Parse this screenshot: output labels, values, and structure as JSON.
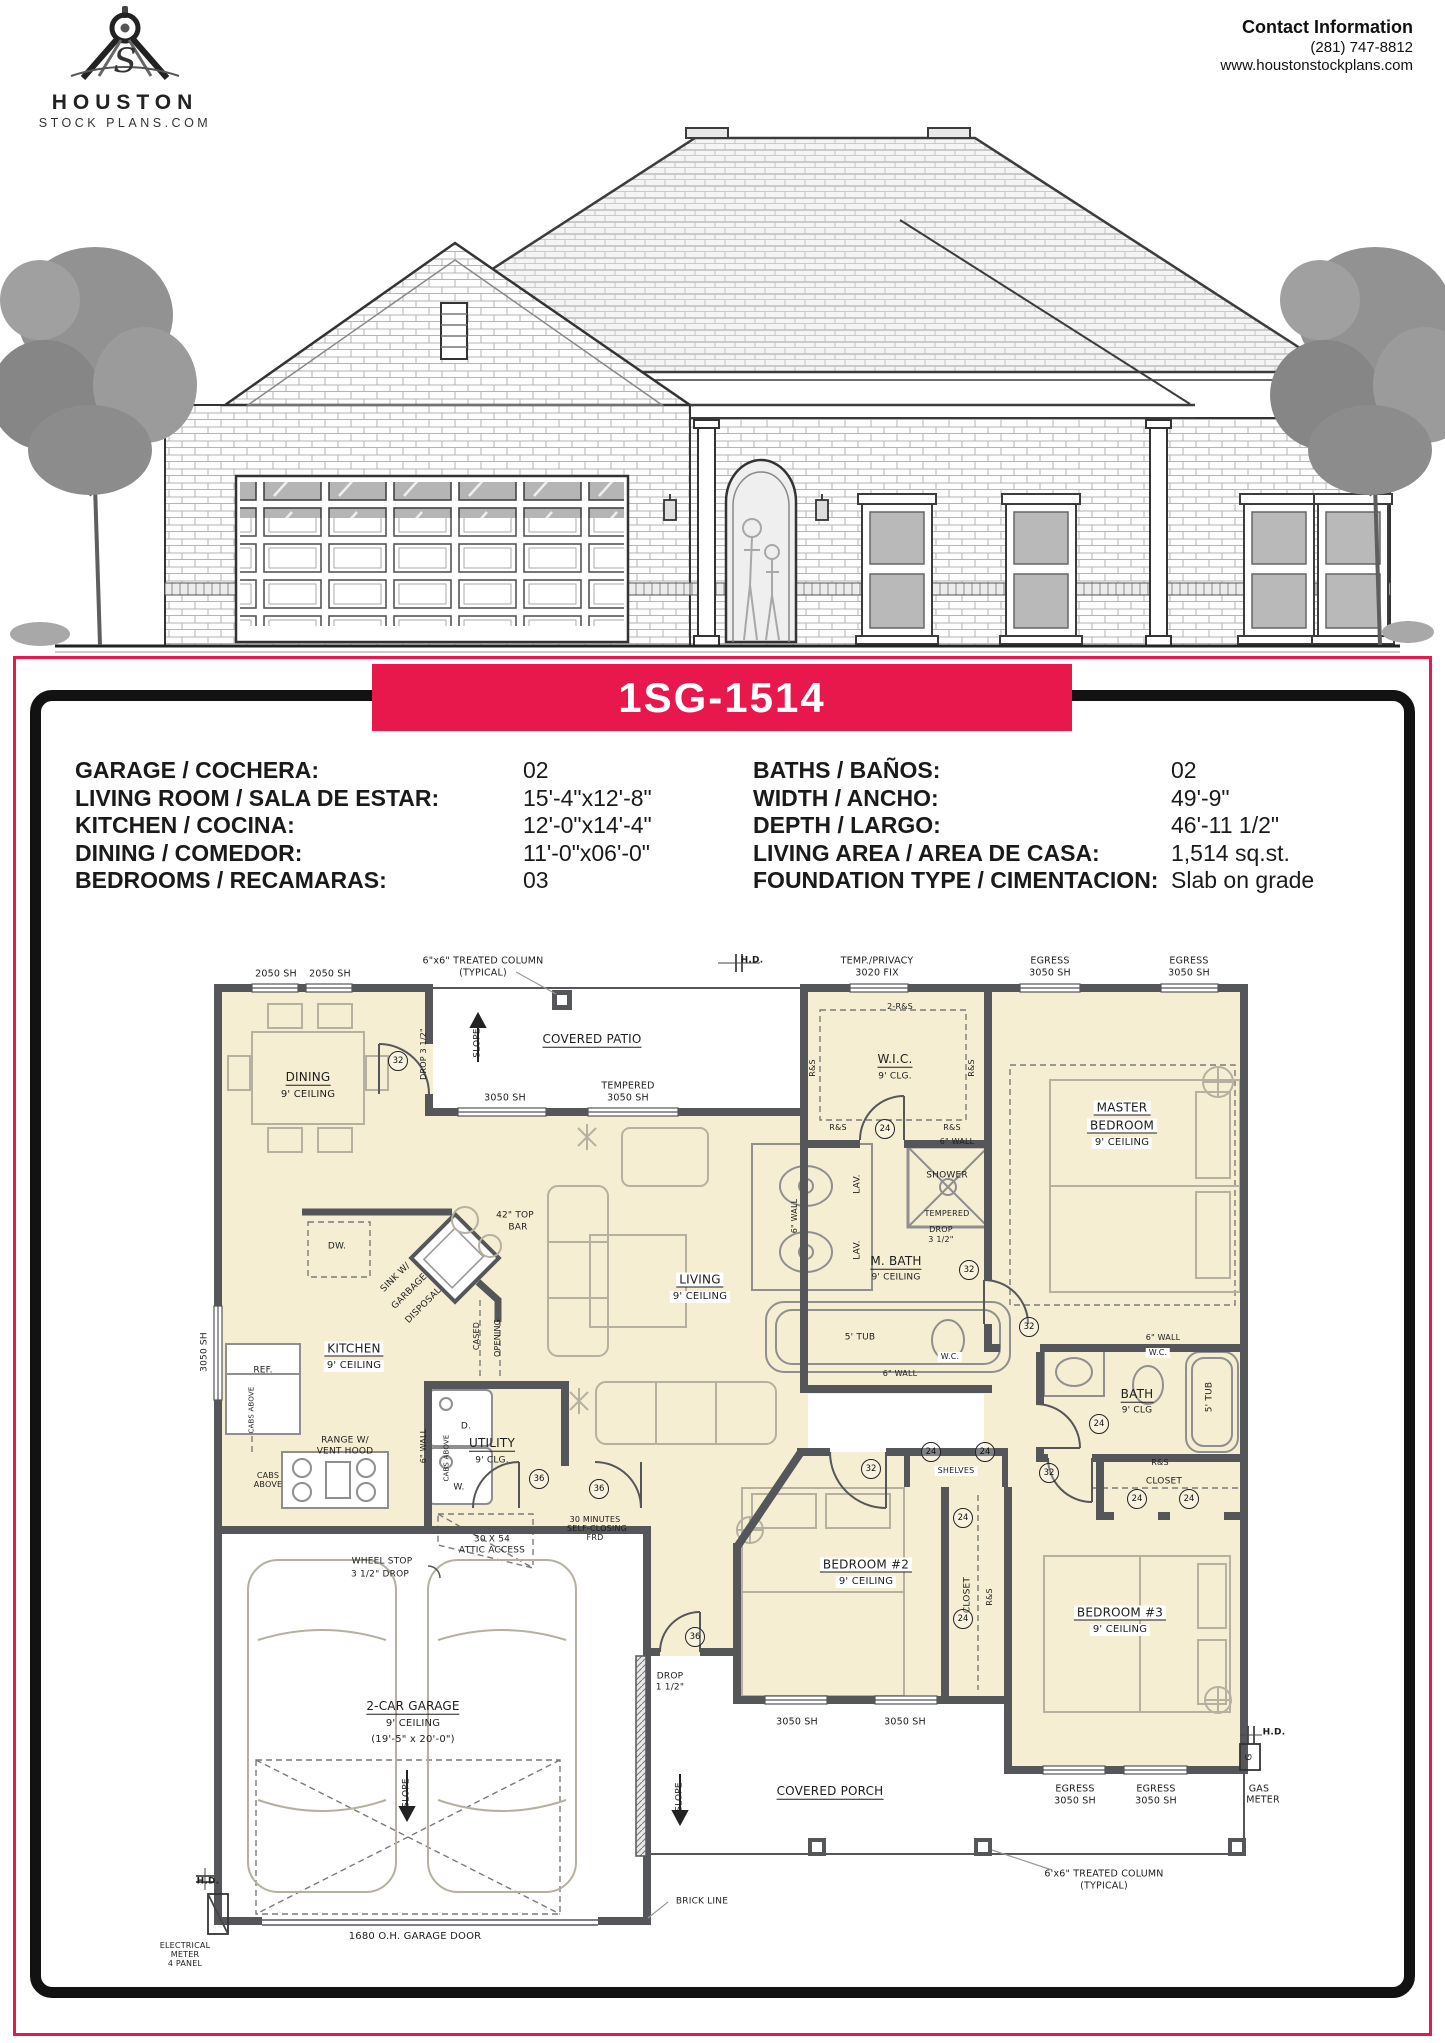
{
  "page": {
    "accent_red": "#E8184D",
    "plan_fill": "#F6EED3",
    "wall_color": "#55565A"
  },
  "header": {
    "logo": {
      "name": "HOUSTON",
      "sub": "STOCK PLANS.COM",
      "icon": "drafting-compass-icon"
    },
    "contact": {
      "title": "Contact Information",
      "phone": "(281) 747-8812",
      "website": "www.houstonstockplans.com"
    }
  },
  "banner": {
    "plan_number": "1SG-1514"
  },
  "specs": {
    "left": [
      {
        "label": "GARAGE / COCHERA:",
        "value": "02"
      },
      {
        "label": "LIVING ROOM / SALA DE ESTAR:",
        "value": "15'-4\"x12'-8\""
      },
      {
        "label": "KITCHEN / COCINA:",
        "value": "12'-0\"x14'-4\""
      },
      {
        "label": "DINING / COMEDOR:",
        "value": "11'-0\"x06'-0\""
      },
      {
        "label": "BEDROOMS / RECAMARAS:",
        "value": "03"
      }
    ],
    "right": [
      {
        "label": "BATHS / BAÑOS:",
        "value": "02"
      },
      {
        "label": "WIDTH / ANCHO:",
        "value": "49'-9\""
      },
      {
        "label": "DEPTH / LARGO:",
        "value": "46'-11 1/2\""
      },
      {
        "label": "LIVING AREA / AREA DE CASA:",
        "value": "1,514 sq.st."
      },
      {
        "label": "FOUNDATION TYPE / CIMENTACION:",
        "value": "Slab on grade"
      }
    ]
  },
  "floorplan": {
    "labels": [
      {
        "t": "2050 SH",
        "x": 276,
        "y": 974
      },
      {
        "t": "2050 SH",
        "x": 330,
        "y": 974
      },
      {
        "t": "6\"x6\" TREATED COLUMN",
        "x": 483,
        "y": 961
      },
      {
        "t": "(TYPICAL)",
        "x": 483,
        "y": 973
      },
      {
        "t": "H.D.",
        "x": 752,
        "y": 961,
        "b": 1,
        "s": 9
      },
      {
        "t": "TEMP./PRIVACY",
        "x": 877,
        "y": 961
      },
      {
        "t": "3020 FIX",
        "x": 877,
        "y": 973
      },
      {
        "t": "EGRESS",
        "x": 1050,
        "y": 961
      },
      {
        "t": "3050 SH",
        "x": 1050,
        "y": 973
      },
      {
        "t": "EGRESS",
        "x": 1189,
        "y": 961
      },
      {
        "t": "3050 SH",
        "x": 1189,
        "y": 973
      },
      {
        "t": "COVERED PATIO",
        "x": 592,
        "y": 1040,
        "s": 12,
        "u": 1
      },
      {
        "t": "SLOPE",
        "x": 478,
        "y": 1043,
        "r": -90,
        "s": 9
      },
      {
        "t": "DROP 3 1/2\"",
        "x": 424,
        "y": 1054,
        "r": -90,
        "s": 8
      },
      {
        "t": "DINING",
        "x": 308,
        "y": 1078,
        "s": 12,
        "u": 1
      },
      {
        "t": "9' CEILING",
        "x": 308,
        "y": 1095,
        "s": 10
      },
      {
        "t": "3050 SH",
        "x": 505,
        "y": 1098
      },
      {
        "t": "TEMPERED",
        "x": 628,
        "y": 1086
      },
      {
        "t": "3050 SH",
        "x": 628,
        "y": 1098
      },
      {
        "t": "2-R&S",
        "x": 900,
        "y": 1007,
        "s": 8
      },
      {
        "t": "R&S",
        "x": 813,
        "y": 1068,
        "r": -90,
        "s": 8
      },
      {
        "t": "R&S",
        "x": 972,
        "y": 1068,
        "r": -90,
        "s": 8
      },
      {
        "t": "W.I.C.",
        "x": 895,
        "y": 1060,
        "s": 12,
        "u": 1
      },
      {
        "t": "9' CLG.",
        "x": 895,
        "y": 1077,
        "s": 9
      },
      {
        "t": "MASTER",
        "x": 1122,
        "y": 1108,
        "s": 12,
        "u": 1,
        "bg": 1
      },
      {
        "t": "BEDROOM",
        "x": 1122,
        "y": 1126,
        "s": 12,
        "u": 1,
        "bg": 1
      },
      {
        "t": "9' CEILING",
        "x": 1122,
        "y": 1143,
        "s": 10,
        "bg": 1
      },
      {
        "t": "R&S",
        "x": 838,
        "y": 1128,
        "s": 8
      },
      {
        "t": "R&S",
        "x": 952,
        "y": 1128,
        "s": 8
      },
      {
        "t": "6\" WALL",
        "x": 957,
        "y": 1142,
        "s": 8
      },
      {
        "t": "42\" TOP",
        "x": 515,
        "y": 1216,
        "s": 9
      },
      {
        "t": "BAR",
        "x": 518,
        "y": 1228,
        "s": 9
      },
      {
        "t": "DW.",
        "x": 337,
        "y": 1247,
        "s": 9
      },
      {
        "t": "SINK W/",
        "x": 396,
        "y": 1278,
        "r": -45,
        "s": 9
      },
      {
        "t": "GARBAGE",
        "x": 410,
        "y": 1292,
        "r": -45,
        "s": 9
      },
      {
        "t": "DISPOSAL",
        "x": 424,
        "y": 1306,
        "r": -45,
        "s": 9
      },
      {
        "t": "LIVING",
        "x": 700,
        "y": 1280,
        "s": 12,
        "u": 1,
        "bg": 1
      },
      {
        "t": "9' CEILING",
        "x": 700,
        "y": 1297,
        "s": 10,
        "bg": 1
      },
      {
        "t": "6\" WALL",
        "x": 795,
        "y": 1216,
        "r": -90,
        "s": 8
      },
      {
        "t": "LAV.",
        "x": 858,
        "y": 1184,
        "r": -90,
        "s": 9
      },
      {
        "t": "LAV.",
        "x": 858,
        "y": 1250,
        "r": -90,
        "s": 9
      },
      {
        "t": "SHOWER",
        "x": 947,
        "y": 1176,
        "s": 9
      },
      {
        "t": "TEMPERED",
        "x": 947,
        "y": 1214,
        "s": 8
      },
      {
        "t": "DROP",
        "x": 941,
        "y": 1230,
        "s": 8
      },
      {
        "t": "3 1/2\"",
        "x": 941,
        "y": 1240,
        "s": 8
      },
      {
        "t": "M. BATH",
        "x": 896,
        "y": 1262,
        "s": 12,
        "u": 1
      },
      {
        "t": "9' CEILING",
        "x": 896,
        "y": 1278,
        "s": 9
      },
      {
        "t": "5' TUB",
        "x": 860,
        "y": 1338,
        "s": 9
      },
      {
        "t": "W.C.",
        "x": 950,
        "y": 1357,
        "s": 8,
        "bg": 1
      },
      {
        "t": "6\" WALL",
        "x": 900,
        "y": 1374,
        "s": 8
      },
      {
        "t": "KITCHEN",
        "x": 354,
        "y": 1349,
        "s": 12,
        "u": 1,
        "bg": 1
      },
      {
        "t": "9' CEILING",
        "x": 354,
        "y": 1366,
        "s": 10,
        "bg": 1
      },
      {
        "t": "CASED",
        "x": 477,
        "y": 1336,
        "r": -90,
        "s": 8
      },
      {
        "t": "OPENING",
        "x": 498,
        "y": 1338,
        "r": -90,
        "s": 8
      },
      {
        "t": "REF.",
        "x": 263,
        "y": 1371,
        "s": 9
      },
      {
        "t": "3050 SH",
        "x": 205,
        "y": 1352,
        "r": -90,
        "s": 9
      },
      {
        "t": "CABS ABOVE",
        "x": 252,
        "y": 1410,
        "r": -90,
        "s": 7
      },
      {
        "t": "CABS",
        "x": 268,
        "y": 1476,
        "s": 8
      },
      {
        "t": "ABOVE",
        "x": 268,
        "y": 1485,
        "s": 8
      },
      {
        "t": "RANGE W/",
        "x": 345,
        "y": 1441,
        "s": 9
      },
      {
        "t": "VENT HOOD",
        "x": 345,
        "y": 1452,
        "s": 9
      },
      {
        "t": "6\" WALL",
        "x": 424,
        "y": 1446,
        "r": -90,
        "s": 8
      },
      {
        "t": "D.",
        "x": 466,
        "y": 1427,
        "s": 9
      },
      {
        "t": "W.",
        "x": 459,
        "y": 1488,
        "s": 9
      },
      {
        "t": "CABS ABOVE",
        "x": 447,
        "y": 1458,
        "r": -90,
        "s": 7
      },
      {
        "t": "UTILITY",
        "x": 492,
        "y": 1444,
        "s": 12,
        "u": 1
      },
      {
        "t": "9' CLG.",
        "x": 492,
        "y": 1461,
        "s": 9
      },
      {
        "t": "6\" WALL",
        "x": 1163,
        "y": 1338,
        "s": 8
      },
      {
        "t": "W.C.",
        "x": 1158,
        "y": 1353,
        "s": 8,
        "bg": 1
      },
      {
        "t": "BATH",
        "x": 1137,
        "y": 1395,
        "s": 12,
        "u": 1
      },
      {
        "t": "9' CLG",
        "x": 1137,
        "y": 1411,
        "s": 9
      },
      {
        "t": "5' TUB",
        "x": 1210,
        "y": 1397,
        "r": -90,
        "s": 9
      },
      {
        "t": "R&S",
        "x": 1160,
        "y": 1463,
        "s": 8
      },
      {
        "t": "CLOSET",
        "x": 1164,
        "y": 1482,
        "s": 9
      },
      {
        "t": "SHELVES",
        "x": 956,
        "y": 1471,
        "s": 8,
        "bg": 1
      },
      {
        "t": "CLOSET",
        "x": 968,
        "y": 1595,
        "r": -90,
        "s": 9
      },
      {
        "t": "R&S",
        "x": 990,
        "y": 1597,
        "r": -90,
        "s": 8
      },
      {
        "t": "30 MINUTES",
        "x": 595,
        "y": 1520,
        "s": 8
      },
      {
        "t": "SELF-CLOSING",
        "x": 597,
        "y": 1529,
        "s": 8
      },
      {
        "t": "FRD",
        "x": 595,
        "y": 1538,
        "s": 8
      },
      {
        "t": "30 X 54",
        "x": 492,
        "y": 1540,
        "s": 9
      },
      {
        "t": "ATTIC ACCESS",
        "x": 492,
        "y": 1551,
        "s": 9
      },
      {
        "t": "WHEEL STOP",
        "x": 382,
        "y": 1562,
        "s": 9
      },
      {
        "t": "3 1/2\" DROP",
        "x": 380,
        "y": 1575,
        "s": 9
      },
      {
        "t": "BEDROOM #2",
        "x": 866,
        "y": 1565,
        "s": 12,
        "u": 1,
        "bg": 1
      },
      {
        "t": "9' CEILING",
        "x": 866,
        "y": 1582,
        "s": 10,
        "bg": 1
      },
      {
        "t": "BEDROOM #3",
        "x": 1120,
        "y": 1613,
        "s": 12,
        "u": 1,
        "bg": 1
      },
      {
        "t": "9' CEILING",
        "x": 1120,
        "y": 1630,
        "s": 10,
        "bg": 1
      },
      {
        "t": "DROP",
        "x": 670,
        "y": 1677,
        "s": 9
      },
      {
        "t": "1 1/2\"",
        "x": 670,
        "y": 1688,
        "s": 9
      },
      {
        "t": "3050 SH",
        "x": 797,
        "y": 1722
      },
      {
        "t": "3050 SH",
        "x": 905,
        "y": 1722
      },
      {
        "t": "2-CAR GARAGE",
        "x": 413,
        "y": 1707,
        "s": 12,
        "u": 1
      },
      {
        "t": "9' CEILING",
        "x": 413,
        "y": 1724,
        "s": 10
      },
      {
        "t": "(19'-5\" x 20'-0\")",
        "x": 413,
        "y": 1740,
        "s": 10
      },
      {
        "t": "SLOPE",
        "x": 407,
        "y": 1793,
        "r": -90,
        "s": 9
      },
      {
        "t": "SLOPE",
        "x": 680,
        "y": 1797,
        "r": -90,
        "s": 9
      },
      {
        "t": "COVERED PORCH",
        "x": 830,
        "y": 1792,
        "s": 12,
        "u": 1
      },
      {
        "t": "EGRESS",
        "x": 1075,
        "y": 1789
      },
      {
        "t": "3050 SH",
        "x": 1075,
        "y": 1801
      },
      {
        "t": "EGRESS",
        "x": 1156,
        "y": 1789
      },
      {
        "t": "3050 SH",
        "x": 1156,
        "y": 1801
      },
      {
        "t": "H.D.",
        "x": 1274,
        "y": 1733,
        "b": 1,
        "s": 9
      },
      {
        "t": "G",
        "x": 1250,
        "y": 1757,
        "r": -90,
        "s": 9
      },
      {
        "t": "GAS",
        "x": 1259,
        "y": 1789
      },
      {
        "t": "METER",
        "x": 1263,
        "y": 1800
      },
      {
        "t": "6'x6\" TREATED COLUMN",
        "x": 1104,
        "y": 1874
      },
      {
        "t": "(TYPICAL)",
        "x": 1104,
        "y": 1886
      },
      {
        "t": "BRICK LINE",
        "x": 702,
        "y": 1902,
        "s": 9
      },
      {
        "t": "1680 O.H. GARAGE DOOR",
        "x": 415,
        "y": 1937,
        "s": 10
      },
      {
        "t": "H.D.",
        "x": 208,
        "y": 1882,
        "b": 1,
        "s": 9
      },
      {
        "t": "ELECTRICAL",
        "x": 185,
        "y": 1946,
        "s": 8
      },
      {
        "t": "METER",
        "x": 185,
        "y": 1955,
        "s": 8
      },
      {
        "t": "4 PANEL",
        "x": 185,
        "y": 1964,
        "s": 8
      }
    ],
    "door_tags": [
      {
        "n": "32",
        "x": 397,
        "y": 1060
      },
      {
        "n": "32",
        "x": 968,
        "y": 1269
      },
      {
        "n": "32",
        "x": 1028,
        "y": 1326
      },
      {
        "n": "32",
        "x": 1048,
        "y": 1472
      },
      {
        "n": "32",
        "x": 870,
        "y": 1468
      },
      {
        "n": "24",
        "x": 884,
        "y": 1128
      },
      {
        "n": "24",
        "x": 1098,
        "y": 1423
      },
      {
        "n": "24",
        "x": 1136,
        "y": 1498
      },
      {
        "n": "24",
        "x": 1188,
        "y": 1498
      },
      {
        "n": "24",
        "x": 930,
        "y": 1451
      },
      {
        "n": "24",
        "x": 984,
        "y": 1451
      },
      {
        "n": "24",
        "x": 962,
        "y": 1517
      },
      {
        "n": "24",
        "x": 962,
        "y": 1618
      },
      {
        "n": "36",
        "x": 538,
        "y": 1478
      },
      {
        "n": "36",
        "x": 598,
        "y": 1488
      },
      {
        "n": "36",
        "x": 694,
        "y": 1636
      }
    ]
  }
}
